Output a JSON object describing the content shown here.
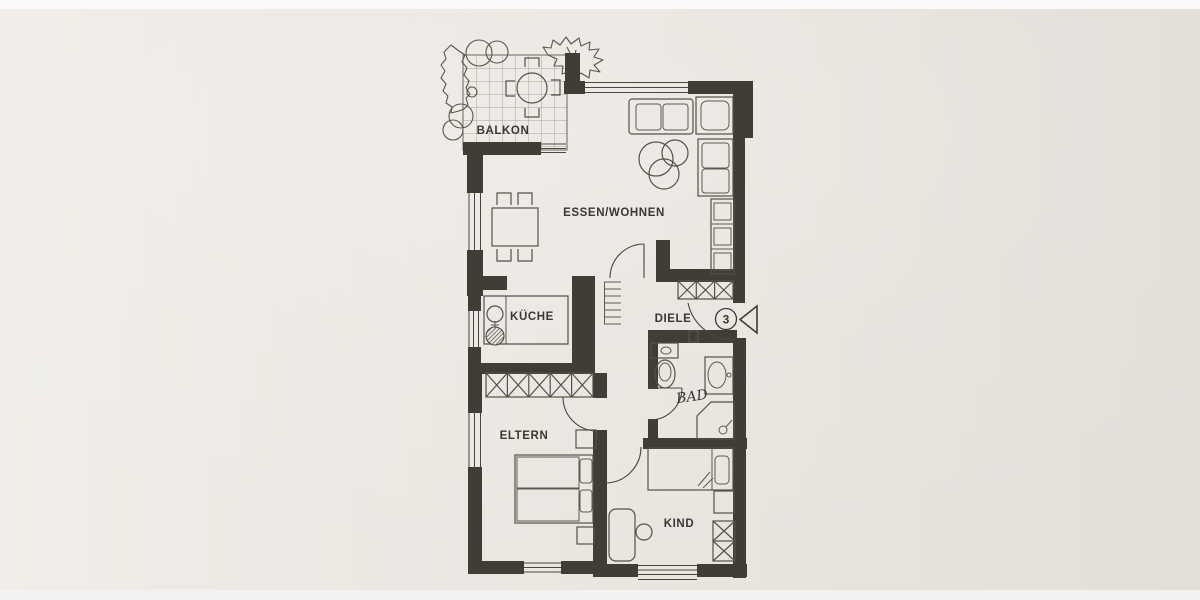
{
  "document": {
    "type": "apartment-floor-plan-photo",
    "rooms": {
      "balkon": {
        "label": "BALKON"
      },
      "essen_wohnen": {
        "label": "ESSEN/WOHNEN"
      },
      "kueche": {
        "label": "KÜCHE"
      },
      "diele": {
        "label": "DIELE"
      },
      "bad": {
        "label": "BAD"
      },
      "eltern": {
        "label": "ELTERN"
      },
      "kind": {
        "label": "KIND"
      }
    },
    "entrance": {
      "unit_number": "3"
    },
    "symbols": {
      "closet": "x-hatched-box",
      "entrance_marker": "triangle-arrow-left",
      "windows": "triple-line",
      "stove": "hatched-circle",
      "sink": "circle-with-cross"
    },
    "colors": {
      "paper": "#eae6e1",
      "paper_light": "#f0ede9",
      "paper_dark": "#e2ddd7",
      "wall": "#403c36",
      "line": "#55504a",
      "top_strip": "#fafaf9",
      "bottom_strip": "#f3f2f0"
    }
  }
}
